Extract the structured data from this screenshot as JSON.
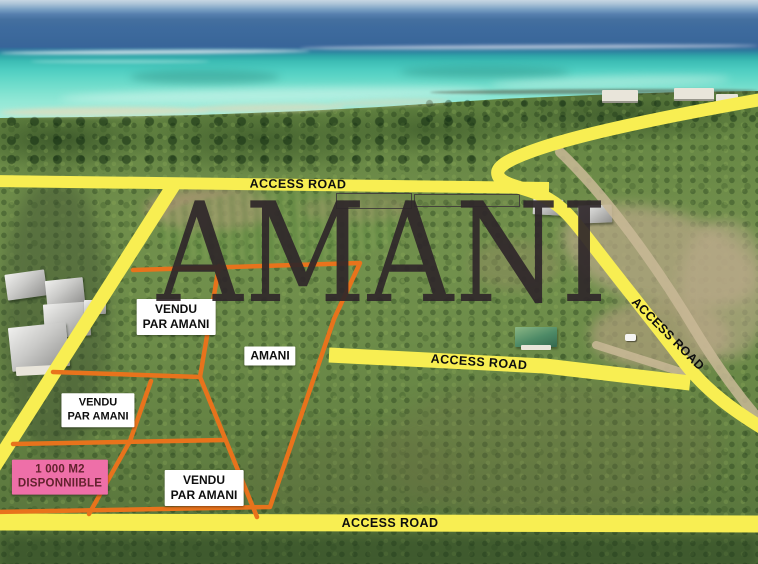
{
  "scene": {
    "type": "aerial-land-sale-photo",
    "watermark_text": "AMANI"
  },
  "road_labels": {
    "top": "ACCESS ROAD",
    "middle": "ACCESS ROAD",
    "right": "ACCESS ROAD",
    "bottom": "ACCESS ROAD"
  },
  "plot_labels": {
    "sold": [
      {
        "line1": "VENDU",
        "line2": "PAR AMANI"
      },
      {
        "line1": "VENDU",
        "line2": "PAR AMANI"
      },
      {
        "line1": "VENDU",
        "line2": "PAR AMANI"
      }
    ],
    "company_plot": "AMANI",
    "available": {
      "line1": "1 000 M2",
      "line2": "DISPONNIIBLE"
    }
  },
  "colors": {
    "road_yellow": "#f8ee52",
    "boundary_orange": "#e8731c",
    "available_pink": "#ee6fa8",
    "available_text": "#63222e",
    "label_bg": "#ffffff",
    "label_text": "#0e0e0e",
    "watermark": "#2f272a"
  }
}
